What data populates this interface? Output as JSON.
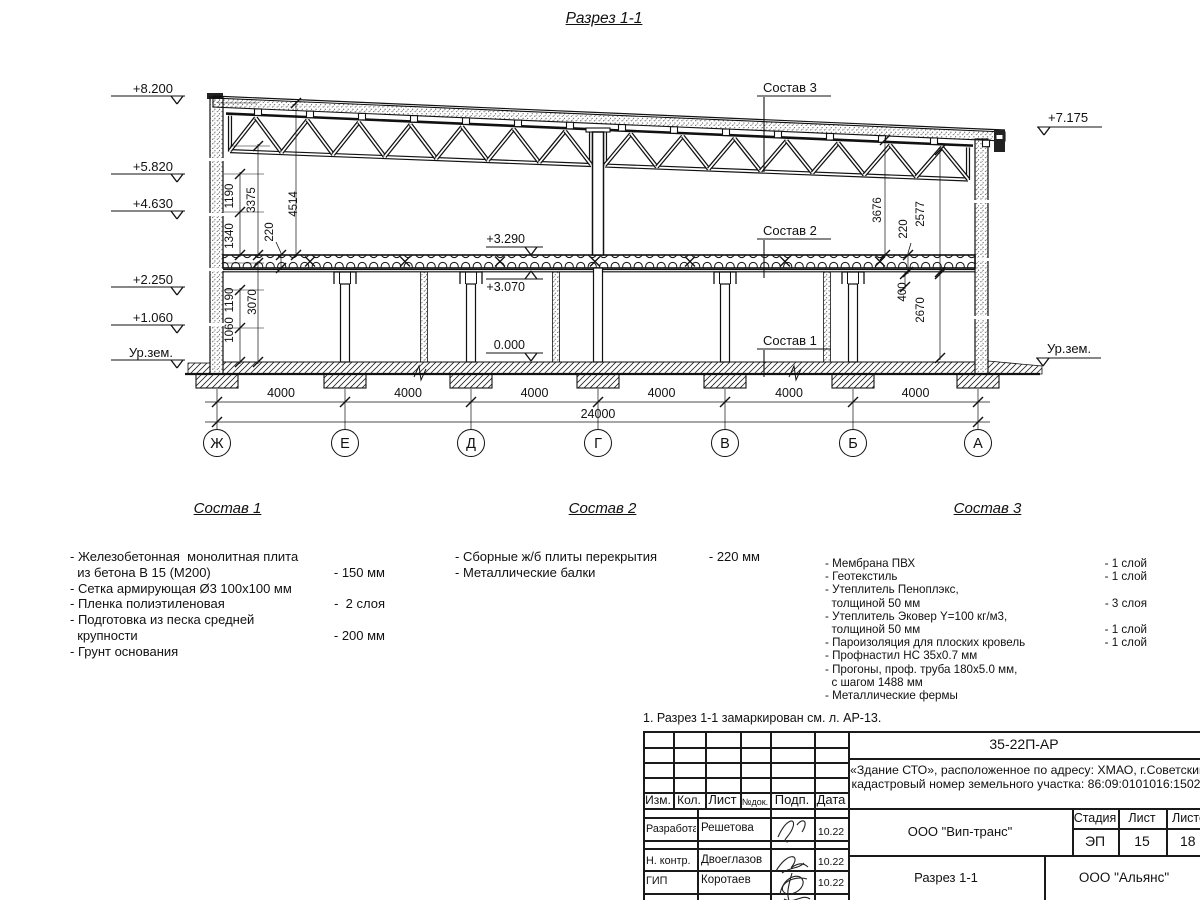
{
  "title": "Разрез 1-1",
  "drawing": {
    "axes": {
      "labels": [
        "Ж",
        "Е",
        "Д",
        "Г",
        "В",
        "Б",
        "А"
      ],
      "xs": [
        217,
        345,
        471,
        598,
        725,
        853,
        978
      ],
      "bay_label": "4000",
      "total_label": "24000"
    },
    "elevation_marks": [
      {
        "label": "+8.200",
        "x": 177,
        "y": 104,
        "side": "left"
      },
      {
        "label": "+5.820",
        "x": 177,
        "y": 182,
        "side": "left"
      },
      {
        "label": "+4.630",
        "x": 177,
        "y": 219,
        "side": "left"
      },
      {
        "label": "+2.250",
        "x": 177,
        "y": 295,
        "side": "left"
      },
      {
        "label": "+1.060",
        "x": 177,
        "y": 333,
        "side": "left"
      },
      {
        "label": "Ур.зем.",
        "x": 177,
        "y": 368,
        "side": "left"
      },
      {
        "label": "+7.175",
        "x": 1044,
        "y": 135,
        "side": "right"
      },
      {
        "label": "Ур.зем.",
        "x": 1043,
        "y": 366,
        "side": "right"
      },
      {
        "label": "+3.290",
        "x": 531,
        "y": 255,
        "side": "mid-down"
      },
      {
        "label": "+3.070",
        "x": 531,
        "y": 271,
        "side": "mid-up"
      },
      {
        "label": "0.000",
        "x": 531,
        "y": 361,
        "side": "mid-down"
      }
    ],
    "dim_labels": [
      {
        "t": "1190",
        "x": 233,
        "y": 196
      },
      {
        "t": "3375",
        "x": 255,
        "y": 200
      },
      {
        "t": "4514",
        "x": 297,
        "y": 204
      },
      {
        "t": "1340",
        "x": 233,
        "y": 236
      },
      {
        "t": "220",
        "x": 273,
        "y": 232
      },
      {
        "t": "1190",
        "x": 233,
        "y": 300
      },
      {
        "t": "3070",
        "x": 256,
        "y": 302
      },
      {
        "t": "1060",
        "x": 233,
        "y": 330
      },
      {
        "t": "3676",
        "x": 881,
        "y": 210
      },
      {
        "t": "220",
        "x": 907,
        "y": 229
      },
      {
        "t": "2577",
        "x": 924,
        "y": 214
      },
      {
        "t": "400",
        "x": 906,
        "y": 292
      },
      {
        "t": "2670",
        "x": 924,
        "y": 310
      }
    ],
    "callouts": [
      {
        "label": "Состав 3",
        "x": 763,
        "y": 92,
        "ly1": 97,
        "ly2": 172
      },
      {
        "label": "Состав 2",
        "x": 763,
        "y": 235,
        "ly1": 240,
        "ly2": 278
      },
      {
        "label": "Состав 1",
        "x": 763,
        "y": 345,
        "ly1": 350,
        "ly2": 377
      }
    ]
  },
  "compositions": [
    {
      "header": "Состав 1",
      "lines": [
        {
          "t": "- Железобетонная  монолитная плита"
        },
        {
          "t": "  из бетона В 15 (М200)",
          "v": "- 150 мм"
        },
        {
          "t": "- Сетка армирующая Ø3 100х100 мм"
        },
        {
          "t": "- Пленка полиэтиленовая",
          "v": "-  2 слоя"
        },
        {
          "t": "- Подготовка из песка средней"
        },
        {
          "t": "  крупности",
          "v": "- 200 мм"
        },
        {
          "t": "- Грунт основания"
        }
      ]
    },
    {
      "header": "Состав 2",
      "lines": [
        {
          "t": "- Сборные ж/б плиты перекрытия",
          "v": "- 220 мм"
        },
        {
          "t": "- Металлические балки"
        }
      ]
    },
    {
      "header": "Состав 3",
      "lines": [
        {
          "t": "- Мембрана ПВХ",
          "v": "- 1 слой"
        },
        {
          "t": "- Геотекстиль",
          "v": "- 1 слой"
        },
        {
          "t": "- Утеплитель Пеноплэкс,"
        },
        {
          "t": "  толщиной 50 мм",
          "v": "- 3 слоя"
        },
        {
          "t": "- Утеплитель Эковер Y=100 кг/м3,"
        },
        {
          "t": "  толщиной 50 мм",
          "v": "- 1 слой"
        },
        {
          "t": "- Пароизоляция для плоских кровель",
          "v": "- 1 слой"
        },
        {
          "t": "- Профнастил НС 35х0.7 мм"
        },
        {
          "t": "- Прогоны, проф. труба 180х5.0 мм,"
        },
        {
          "t": "  с шагом 1488 мм"
        },
        {
          "t": "- Металлические фермы"
        }
      ]
    }
  ],
  "note": "1. Разрез 1-1 замаркирован см. л. АР-13.",
  "title_block": {
    "doc_number": "35-22П-АР",
    "object_line1": "«Здание СТО», расположенное по адресу: ХМАО, г.Советский",
    "object_line2": "кадастровый номер земельного участка: 86:09:0101016:1502",
    "col_izm": "Изм.",
    "col_kol": "Кол.",
    "col_list": "Лист",
    "col_ndok": "№док.",
    "col_podp": "Подп.",
    "col_data": "Дата",
    "rows": [
      {
        "role": "Разработал",
        "name": "Решетова",
        "date": "10.22"
      },
      {
        "role": "Н. контр.",
        "name": "Двоеглазов",
        "date": "10.22"
      },
      {
        "role": "ГИП",
        "name": "Коротаев",
        "date": "10.22"
      }
    ],
    "org1": "ООО \"Вип-транс\"",
    "stage_label": "Стадия",
    "sheet_label": "Лист",
    "sheets_label": "Листов",
    "stage": "ЭП",
    "sheet": "15",
    "sheets": "18",
    "sheet_title": "Разрез 1-1",
    "org2": "ООО \"Альянс\""
  }
}
